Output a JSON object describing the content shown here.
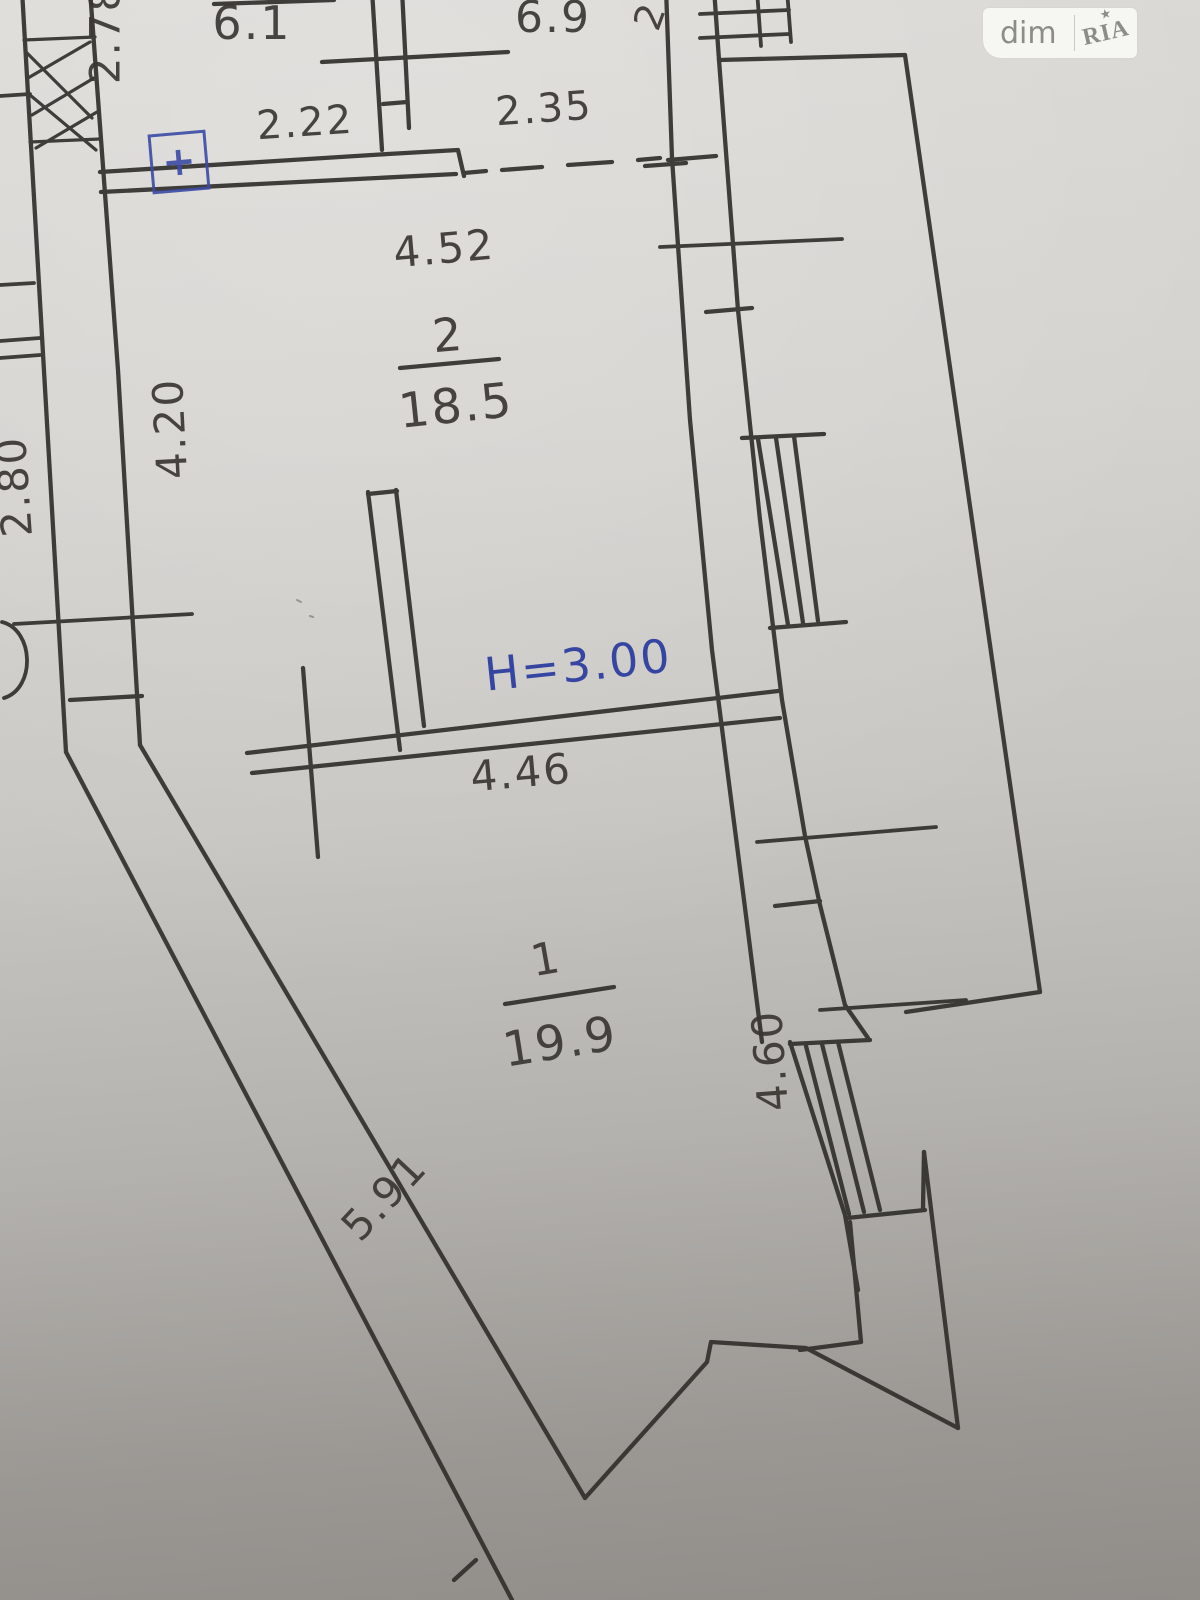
{
  "document": {
    "kind": "hand-drawn apartment floor plan (photographed paper)"
  },
  "watermark": {
    "dim": "dim",
    "ria": "RIA",
    "star": "★"
  },
  "rooms": {
    "room1": {
      "number": "1",
      "area": "19.9"
    },
    "room2": {
      "number": "2",
      "area": "18.5"
    },
    "top_left_room": {
      "area": "6.1"
    },
    "top_middle_room": {
      "area": "6.9"
    }
  },
  "annotations": {
    "height_note": "H=3.00",
    "electric_symbol": "+",
    "partial_vertical_digit": "2"
  },
  "dimensions": {
    "d2_78": "2.78",
    "d2_22": "2.22",
    "d2_35": "2.35",
    "d4_52": "4.52",
    "d4_20": "4.20",
    "d2_80": "2.80",
    "d4_46": "4.46",
    "d5_91": "5.91",
    "d4_60": "4.60"
  }
}
